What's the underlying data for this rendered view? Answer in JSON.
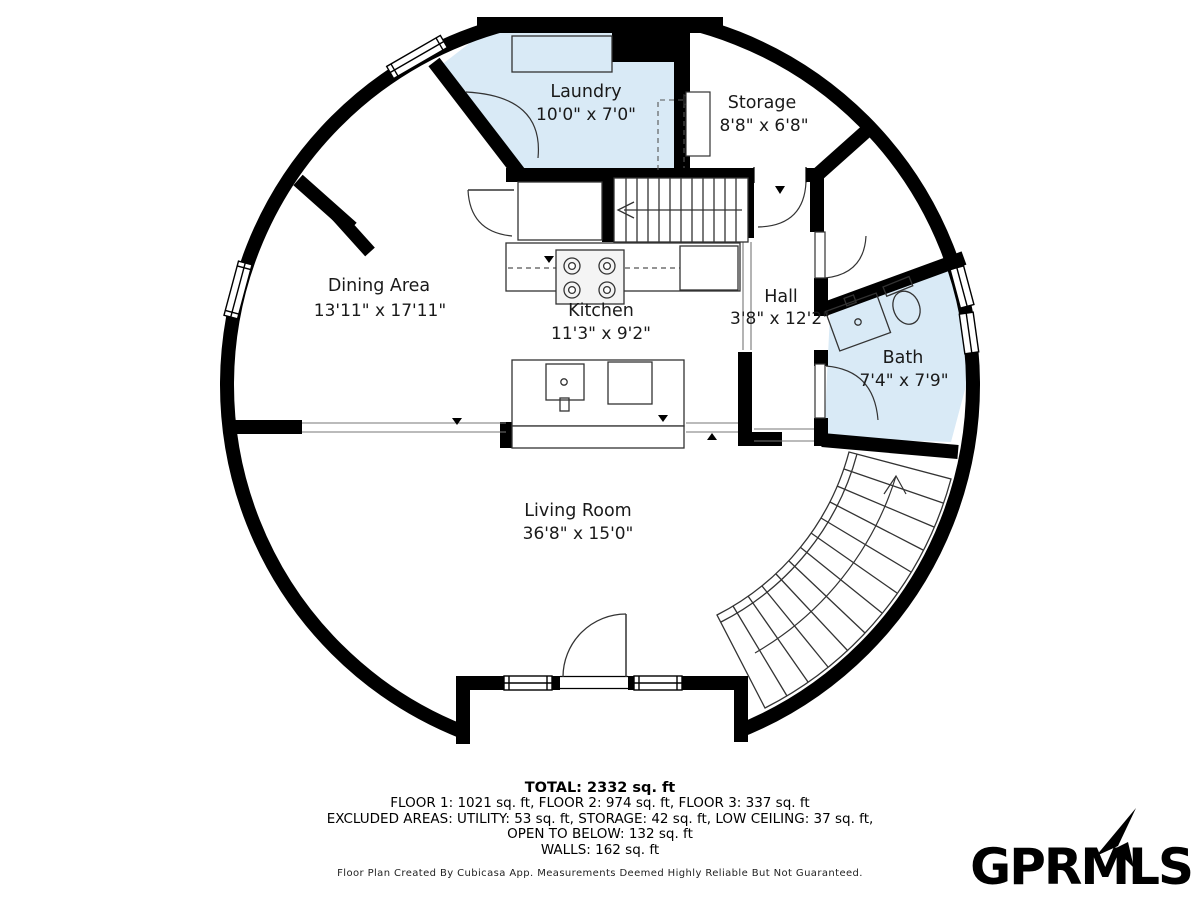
{
  "floor_plan": {
    "rooms": [
      {
        "name": "Laundry",
        "dims": "10'0\" x 7'0\""
      },
      {
        "name": "Storage",
        "dims": "8'8\" x 6'8\""
      },
      {
        "name": "Dining Area",
        "dims": "13'11\" x 17'11\""
      },
      {
        "name": "Kitchen",
        "dims": "11'3\" x 9'2\""
      },
      {
        "name": "Hall",
        "dims": "3'8\" x 12'2\""
      },
      {
        "name": "Bath",
        "dims": "7'4\" x 7'9\""
      },
      {
        "name": "Living Room",
        "dims": "36'8\" x 15'0\""
      }
    ],
    "colors": {
      "wall": "#000000",
      "room_highlight": "#d9eaf6",
      "text": "#1a1a1a"
    },
    "icons": [
      "stairs-up-arrow-icon",
      "stairs-direction-arrow-icon",
      "door-swing-icon",
      "window-icon",
      "stove-burners-icon",
      "sink-icon",
      "toilet-icon"
    ]
  },
  "summary": {
    "total": "TOTAL: 2332 sq. ft",
    "line1": "FLOOR 1: 1021 sq. ft, FLOOR 2: 974 sq. ft, FLOOR 3: 337 sq. ft",
    "line2": "EXCLUDED AREAS: UTILITY: 53 sq. ft, STORAGE: 42 sq. ft, LOW CEILING: 37 sq. ft,",
    "line3": "OPEN TO BELOW: 132 sq. ft",
    "line4": "WALLS: 162 sq. ft"
  },
  "disclaimer": "Floor Plan Created By Cubicasa App. Measurements Deemed Highly Reliable But Not Guaranteed.",
  "logo": {
    "text": "GPRMLS"
  }
}
